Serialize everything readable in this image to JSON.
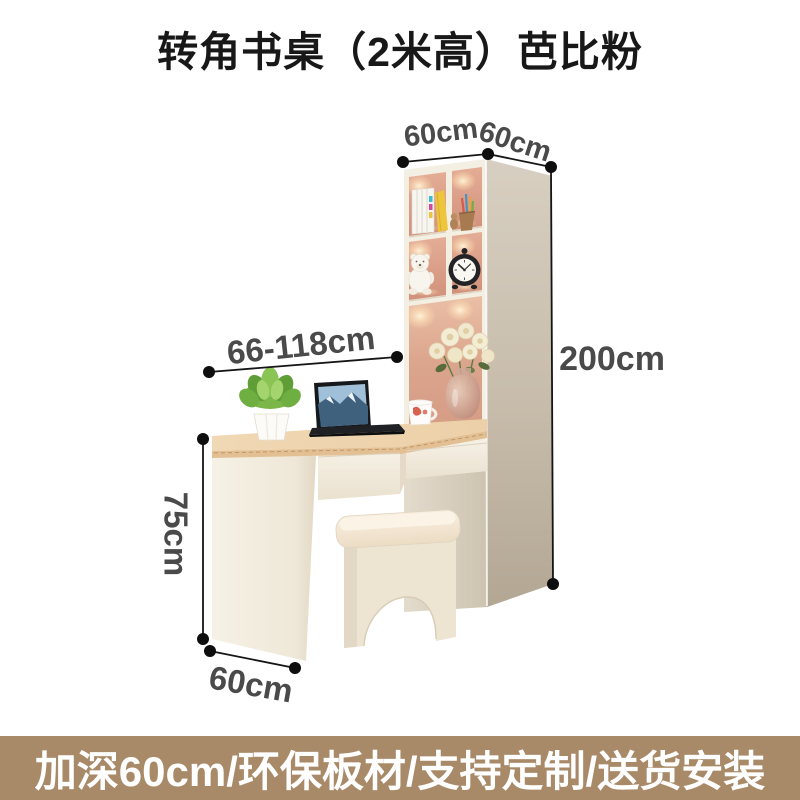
{
  "title": "转角书桌（2米高）芭比粉",
  "banner": {
    "text": "加深60cm/环保板材/支持定制/送货安装",
    "background": "#a98a68",
    "text_color": "#ffffff"
  },
  "dimensions": {
    "cabinet_top_depth": "60cm",
    "cabinet_top_width": "60cm",
    "desk_length_range": "66-118cm",
    "cabinet_height": "200cm",
    "desk_height": "75cm",
    "desk_end_depth": "60cm"
  },
  "scene_items": [
    "books",
    "colored-pencil-cup",
    "teddy-bear",
    "alarm-clock",
    "flower-vase",
    "succulent-plant",
    "laptop",
    "coffee-mug",
    "stool"
  ],
  "colors": {
    "dimension_text": "#4a4a4a",
    "dimension_line": "#151515",
    "cabinet_back_panel": "#d89c85",
    "cabinet_side": "#c9bfae",
    "desk_wood_top": "#eed4ae",
    "furniture_cream": "#f2ecdf"
  }
}
